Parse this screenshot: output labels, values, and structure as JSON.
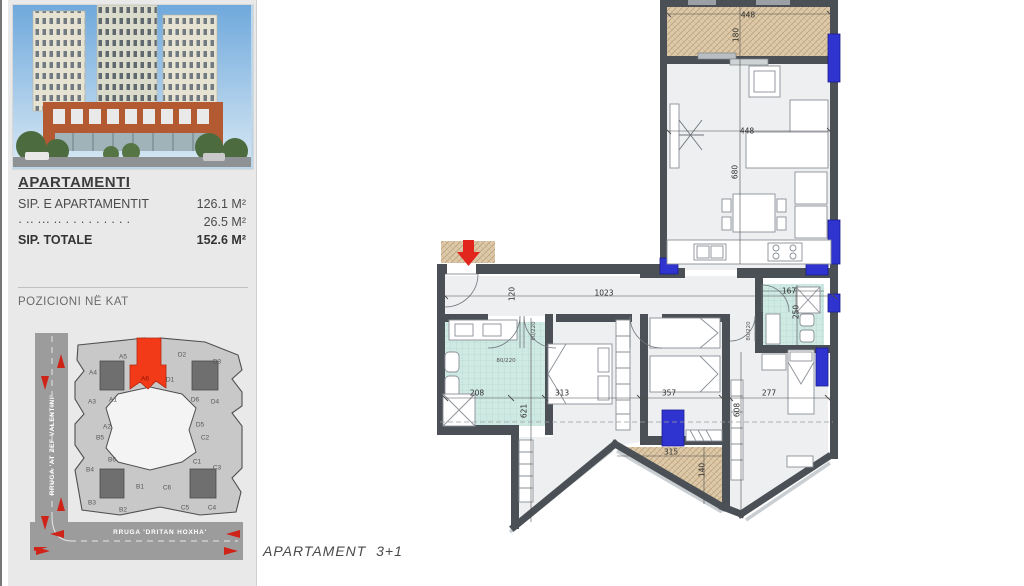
{
  "sidebar": {
    "photo_alt": "building-render",
    "info": {
      "title": "APARTAMENTI",
      "rows": [
        {
          "label": "SIP. E APARTAMENTIT",
          "value": "126.1 M²",
          "bold": false
        },
        {
          "label": "· ·· ··· ··  · · · · · · · · ·",
          "value": "26.5 M²",
          "bold": false
        },
        {
          "label": "SIP. TOTALE",
          "value": "152.6 M²",
          "bold": true
        }
      ]
    },
    "position_title": "POZICIONI NË KAT",
    "keyplan": {
      "street_left": "RRUGA 'AT ZEF VALENTINI'",
      "street_bottom": "RRUGA 'DRITAN HOXHA'",
      "highlighted_unit": "A6",
      "units": [
        {
          "id": "A5",
          "x": 123,
          "y": 357
        },
        {
          "id": "A4",
          "x": 93,
          "y": 373
        },
        {
          "id": "A6",
          "x": 145,
          "y": 379,
          "hl": true
        },
        {
          "id": "A3",
          "x": 92,
          "y": 402
        },
        {
          "id": "A1",
          "x": 113,
          "y": 400
        },
        {
          "id": "A2",
          "x": 107,
          "y": 427
        },
        {
          "id": "B5",
          "x": 100,
          "y": 438
        },
        {
          "id": "B6",
          "x": 112,
          "y": 460
        },
        {
          "id": "B4",
          "x": 90,
          "y": 470
        },
        {
          "id": "B3",
          "x": 92,
          "y": 503
        },
        {
          "id": "B1",
          "x": 140,
          "y": 487
        },
        {
          "id": "B2",
          "x": 123,
          "y": 510
        },
        {
          "id": "C6",
          "x": 167,
          "y": 488
        },
        {
          "id": "C5",
          "x": 185,
          "y": 508
        },
        {
          "id": "C4",
          "x": 212,
          "y": 508
        },
        {
          "id": "C1",
          "x": 197,
          "y": 462
        },
        {
          "id": "C2",
          "x": 205,
          "y": 438
        },
        {
          "id": "C3",
          "x": 217,
          "y": 468
        },
        {
          "id": "D2",
          "x": 182,
          "y": 355
        },
        {
          "id": "D3",
          "x": 217,
          "y": 362
        },
        {
          "id": "D1",
          "x": 170,
          "y": 380
        },
        {
          "id": "D6",
          "x": 195,
          "y": 400
        },
        {
          "id": "D4",
          "x": 215,
          "y": 402
        },
        {
          "id": "D5",
          "x": 200,
          "y": 425
        }
      ]
    }
  },
  "floorplan": {
    "dimensions": [
      {
        "t": "448",
        "x": 748,
        "y": 15,
        "r": 0
      },
      {
        "t": "180",
        "x": 736,
        "y": 35,
        "r": -90
      },
      {
        "t": "448",
        "x": 747,
        "y": 131,
        "r": 0
      },
      {
        "t": "680",
        "x": 735,
        "y": 172,
        "r": -90
      },
      {
        "t": "1023",
        "x": 604,
        "y": 293,
        "r": 0
      },
      {
        "t": "120",
        "x": 512,
        "y": 294,
        "r": -90
      },
      {
        "t": "167",
        "x": 789,
        "y": 291,
        "r": 0
      },
      {
        "t": "250",
        "x": 796,
        "y": 312,
        "r": -90
      },
      {
        "t": "208",
        "x": 477,
        "y": 393,
        "r": 0
      },
      {
        "t": "313",
        "x": 562,
        "y": 393,
        "r": 0
      },
      {
        "t": "357",
        "x": 669,
        "y": 393,
        "r": 0
      },
      {
        "t": "277",
        "x": 769,
        "y": 393,
        "r": 0
      },
      {
        "t": "621",
        "x": 524,
        "y": 411,
        "r": -90
      },
      {
        "t": "608",
        "x": 737,
        "y": 410,
        "r": -90
      },
      {
        "t": "315",
        "x": 671,
        "y": 452,
        "r": 0
      },
      {
        "t": "140",
        "x": 702,
        "y": 470,
        "r": -90
      }
    ],
    "door_labels": [
      {
        "t": "80/220",
        "x": 506,
        "y": 361,
        "r": 0
      },
      {
        "t": "80/220",
        "x": 534,
        "y": 331,
        "r": -90
      },
      {
        "t": "80/220",
        "x": 644,
        "y": 331,
        "r": -90
      },
      {
        "t": "80/220",
        "x": 749,
        "y": 331,
        "r": -90
      }
    ],
    "colors": {
      "wall": "#4a5055",
      "window_blue": "#2f33cf",
      "balcony_hatch": "#dcc9a9",
      "bath_teal": "#cfe9e3",
      "floor_gray": "#edeff0",
      "entry_arrow_red": "#e3261d",
      "keyplan_highlight": "#f23a18"
    }
  },
  "footer": {
    "caption": "APARTAMENT  3+1"
  }
}
